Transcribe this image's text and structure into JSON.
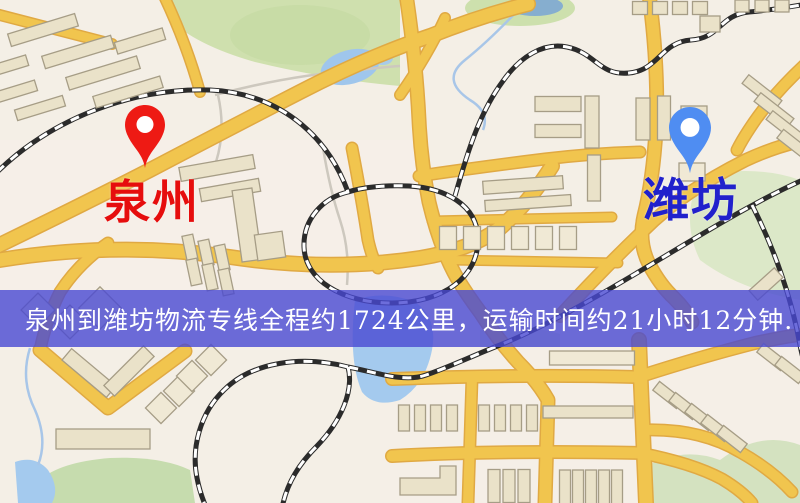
{
  "banner": {
    "text": "泉州到潍坊物流专线全程约1724公里，运输时间约21小时12分钟.",
    "background_color": "#4848d2",
    "text_color": "#ffffff",
    "route": {
      "origin": "泉州",
      "destination": "潍坊",
      "service_type": "物流专线",
      "distance": "约1724公里",
      "duration": "约21小时12分钟"
    }
  },
  "map": {
    "origin_marker": {
      "label": "泉州",
      "pin_color": "#ee1a14",
      "label_color": "#e60d0d"
    },
    "destination_marker": {
      "label": "潍坊",
      "pin_color": "#4f8df2",
      "label_color": "#2121cc"
    },
    "palette": {
      "background": "#f4efe6",
      "road": "#f1c54e",
      "park": "#cfe0ae",
      "water": "#9fc6ec",
      "building": "#eae2c9",
      "railway": "#2b2b2b"
    }
  }
}
